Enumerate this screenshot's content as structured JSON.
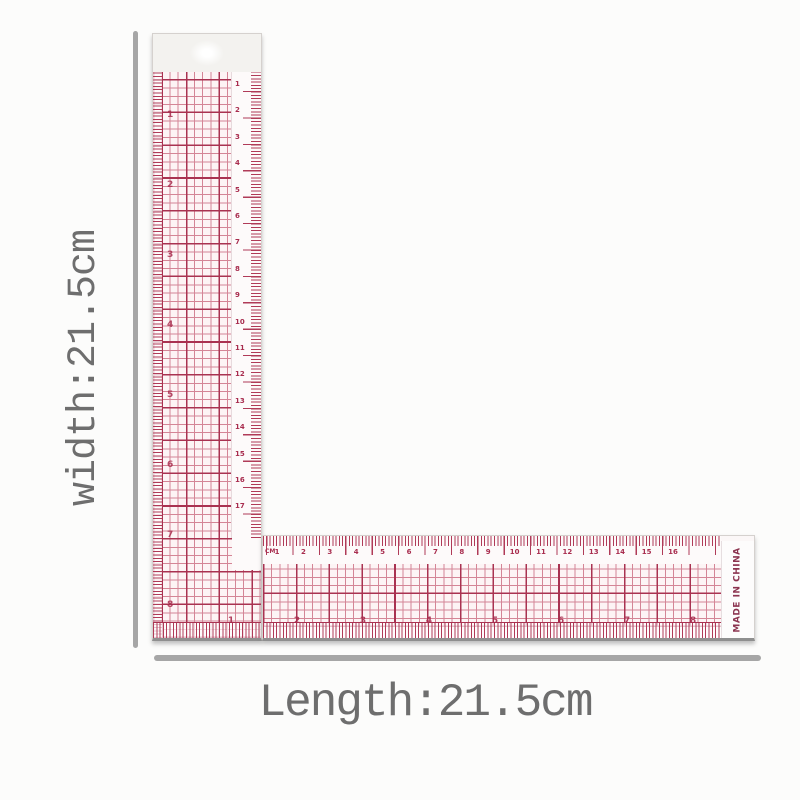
{
  "annotations": {
    "width_label": "width:21.5cm",
    "length_label": "Length:21.5cm"
  },
  "ruler": {
    "made_in": "MADE IN CHINA",
    "unit_label": "CM",
    "horizontal_cm_numbers": [
      "1",
      "2",
      "3",
      "4",
      "5",
      "6",
      "7",
      "8",
      "9",
      "10",
      "11",
      "12",
      "13",
      "14",
      "15",
      "16"
    ],
    "vertical_cm_numbers": [
      "1",
      "2",
      "3",
      "4",
      "5",
      "6",
      "7",
      "8",
      "9",
      "10",
      "11",
      "12",
      "13",
      "14",
      "15",
      "16",
      "17"
    ],
    "horizontal_inch_numbers": [
      "1",
      "2",
      "3",
      "4",
      "5",
      "6",
      "7",
      "8"
    ],
    "vertical_inch_numbers": [
      "1",
      "2",
      "3",
      "4",
      "5",
      "6",
      "7",
      "8"
    ]
  },
  "colors": {
    "page-bg": "#fcfcfb",
    "arm-bg": "#fbf7f7",
    "body-bg": "#fdf4f5",
    "strip-bg": "#fdfafa",
    "tab-bg": "#f3f2ef",
    "grid-fine": "#d48596",
    "grid-heavy": "#a93251",
    "tick": "#b03b58",
    "number": "#a82c4e",
    "made-in": "#8c3450",
    "edge": "#d5d1ce",
    "shadow-edge": "#8f8f8f",
    "dim-line": "#a6a6a6",
    "dim-text": "#6e6e6e"
  }
}
